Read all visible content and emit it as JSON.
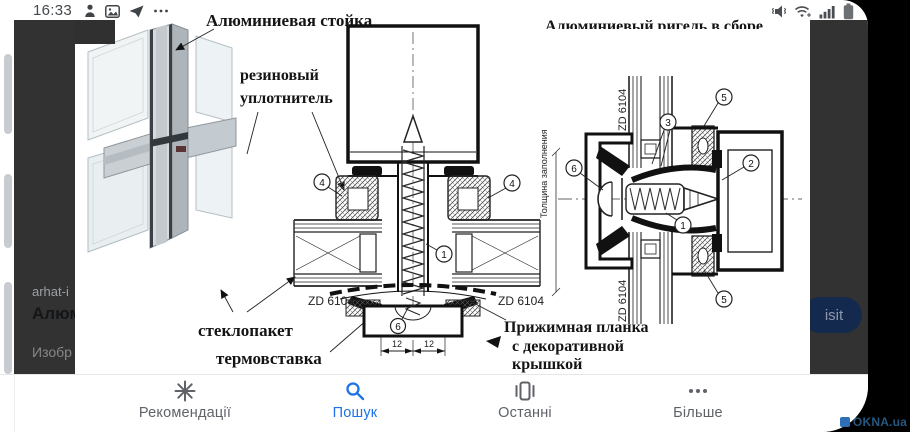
{
  "status_bar": {
    "time": "16:33"
  },
  "background_page": {
    "site": "arhat-i",
    "title": "Алюм",
    "images_label": "Изобр"
  },
  "viewer": {
    "visit_button": "isit"
  },
  "diagram": {
    "labels": {
      "mullion": "Алюминиевая стойка",
      "assembly_clipped": "Алюминиевый ригель в сборе",
      "rubber_1": "резиновый",
      "rubber_2": "уплотнитель",
      "glass_unit": "стеклопакет",
      "thermal_insert": "термовставка",
      "plate_1": "Прижимная планка",
      "plate_2": "с декоративной",
      "plate_3": "крышкой",
      "infill_thickness": "Толщина заполнения",
      "profile_code": "ZD 6104"
    },
    "dimensions": [
      "12",
      "12"
    ],
    "center_callouts": [
      "4",
      "4",
      "1",
      "6"
    ],
    "right_callouts": [
      "5",
      "3",
      "2",
      "6",
      "1",
      "5"
    ]
  },
  "nav": {
    "items": [
      {
        "label": "Рекомендації",
        "icon": "sparkle-icon",
        "active": false
      },
      {
        "label": "Пошук",
        "icon": "search-icon",
        "active": true
      },
      {
        "label": "Останні",
        "icon": "recent-icon",
        "active": false
      },
      {
        "label": "Більше",
        "icon": "more-icon",
        "active": false
      }
    ]
  },
  "watermark": "OKNA.ua",
  "colors": {
    "accent": "#1a73e8",
    "overlay": "#323232",
    "visit_button_bg": "#14294e",
    "watermark_text": "#27577f"
  }
}
